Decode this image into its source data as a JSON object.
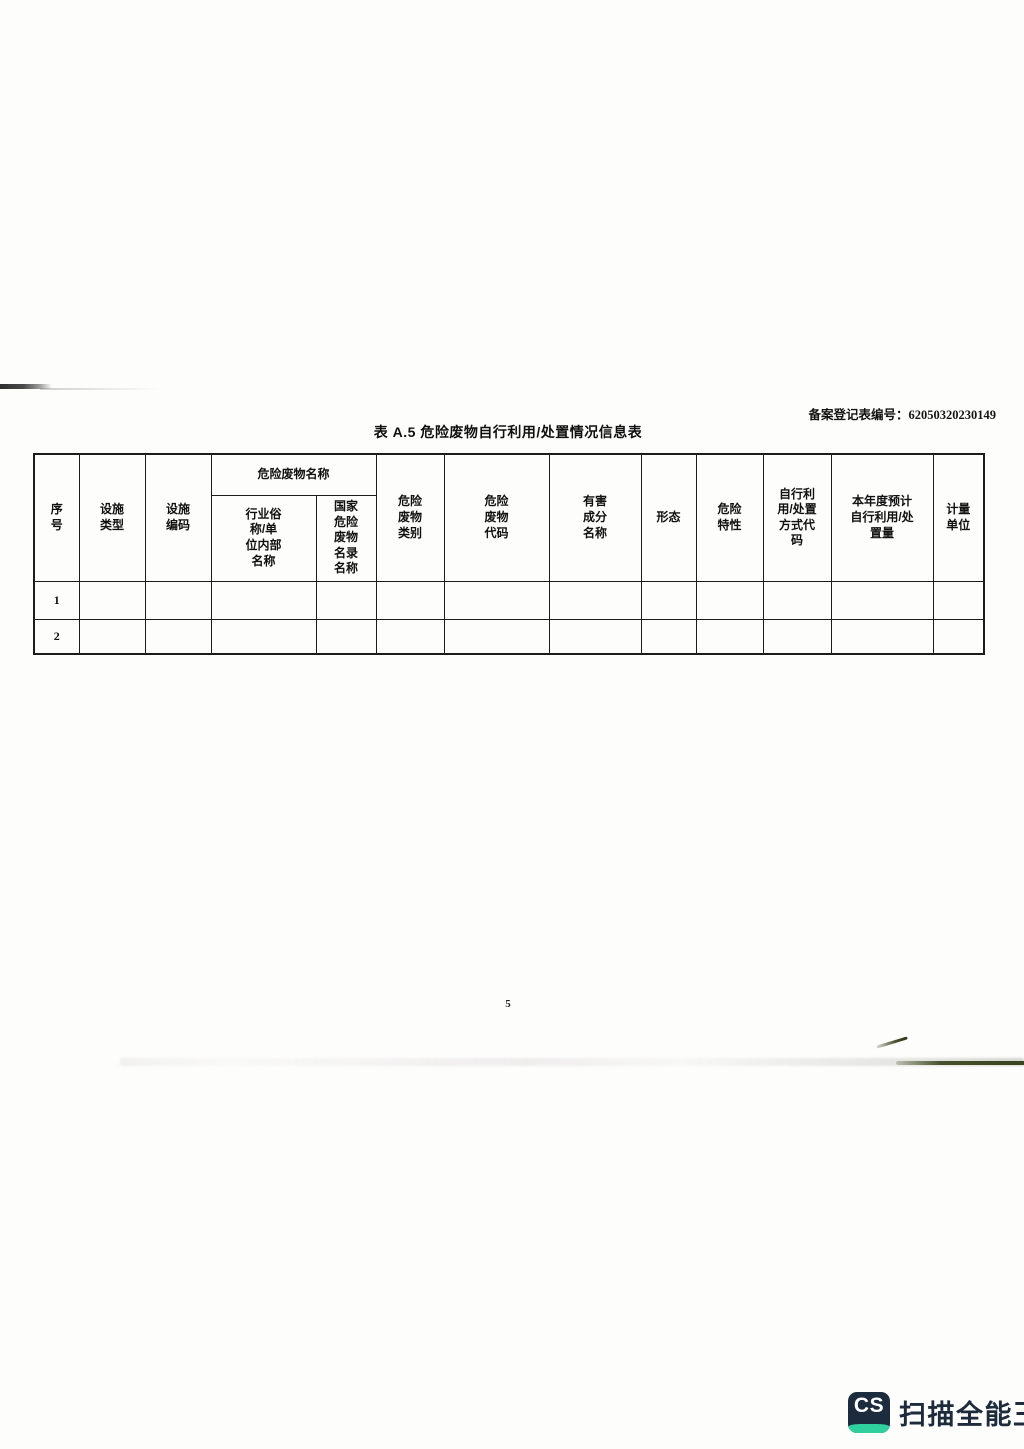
{
  "page": {
    "record_label": "备案登记表编号：",
    "record_number": "62050320230149",
    "title": "表 A.5 危险废物自行利用/处置情况信息表",
    "page_number": "5"
  },
  "table": {
    "group_header": "危险废物名称",
    "headers": {
      "index": "序\n号",
      "facility_type": "设施\n类型",
      "facility_code": "设施\n编码",
      "industry_name": "行业俗\n称/单\n位内部\n名称",
      "national_name": "国家\n危险\n废物\n名录\n名称",
      "waste_category": "危险\n废物\n类别",
      "waste_code": "危险\n废物\n代码",
      "harmful_component": "有害\n成分\n名称",
      "form": "形态",
      "hazard_property": "危险\n特性",
      "method_code": "自行利\n用/处置\n方式代\n码",
      "annual_amount": "本年度预计\n自行利用/处\n置量",
      "unit": "计量\n单位"
    },
    "rows": [
      {
        "no": "1",
        "cells": [
          "",
          "",
          "",
          "",
          "",
          "",
          "",
          "",
          "",
          "",
          "",
          ""
        ]
      },
      {
        "no": "2",
        "cells": [
          "",
          "",
          "",
          "",
          "",
          "",
          "",
          "",
          "",
          "",
          "",
          ""
        ]
      }
    ]
  },
  "watermark": {
    "icon_text": "CS",
    "app_name": "扫描全能王",
    "navy_color": "#1c2b3e",
    "teal_color": "#2fcf9e"
  }
}
